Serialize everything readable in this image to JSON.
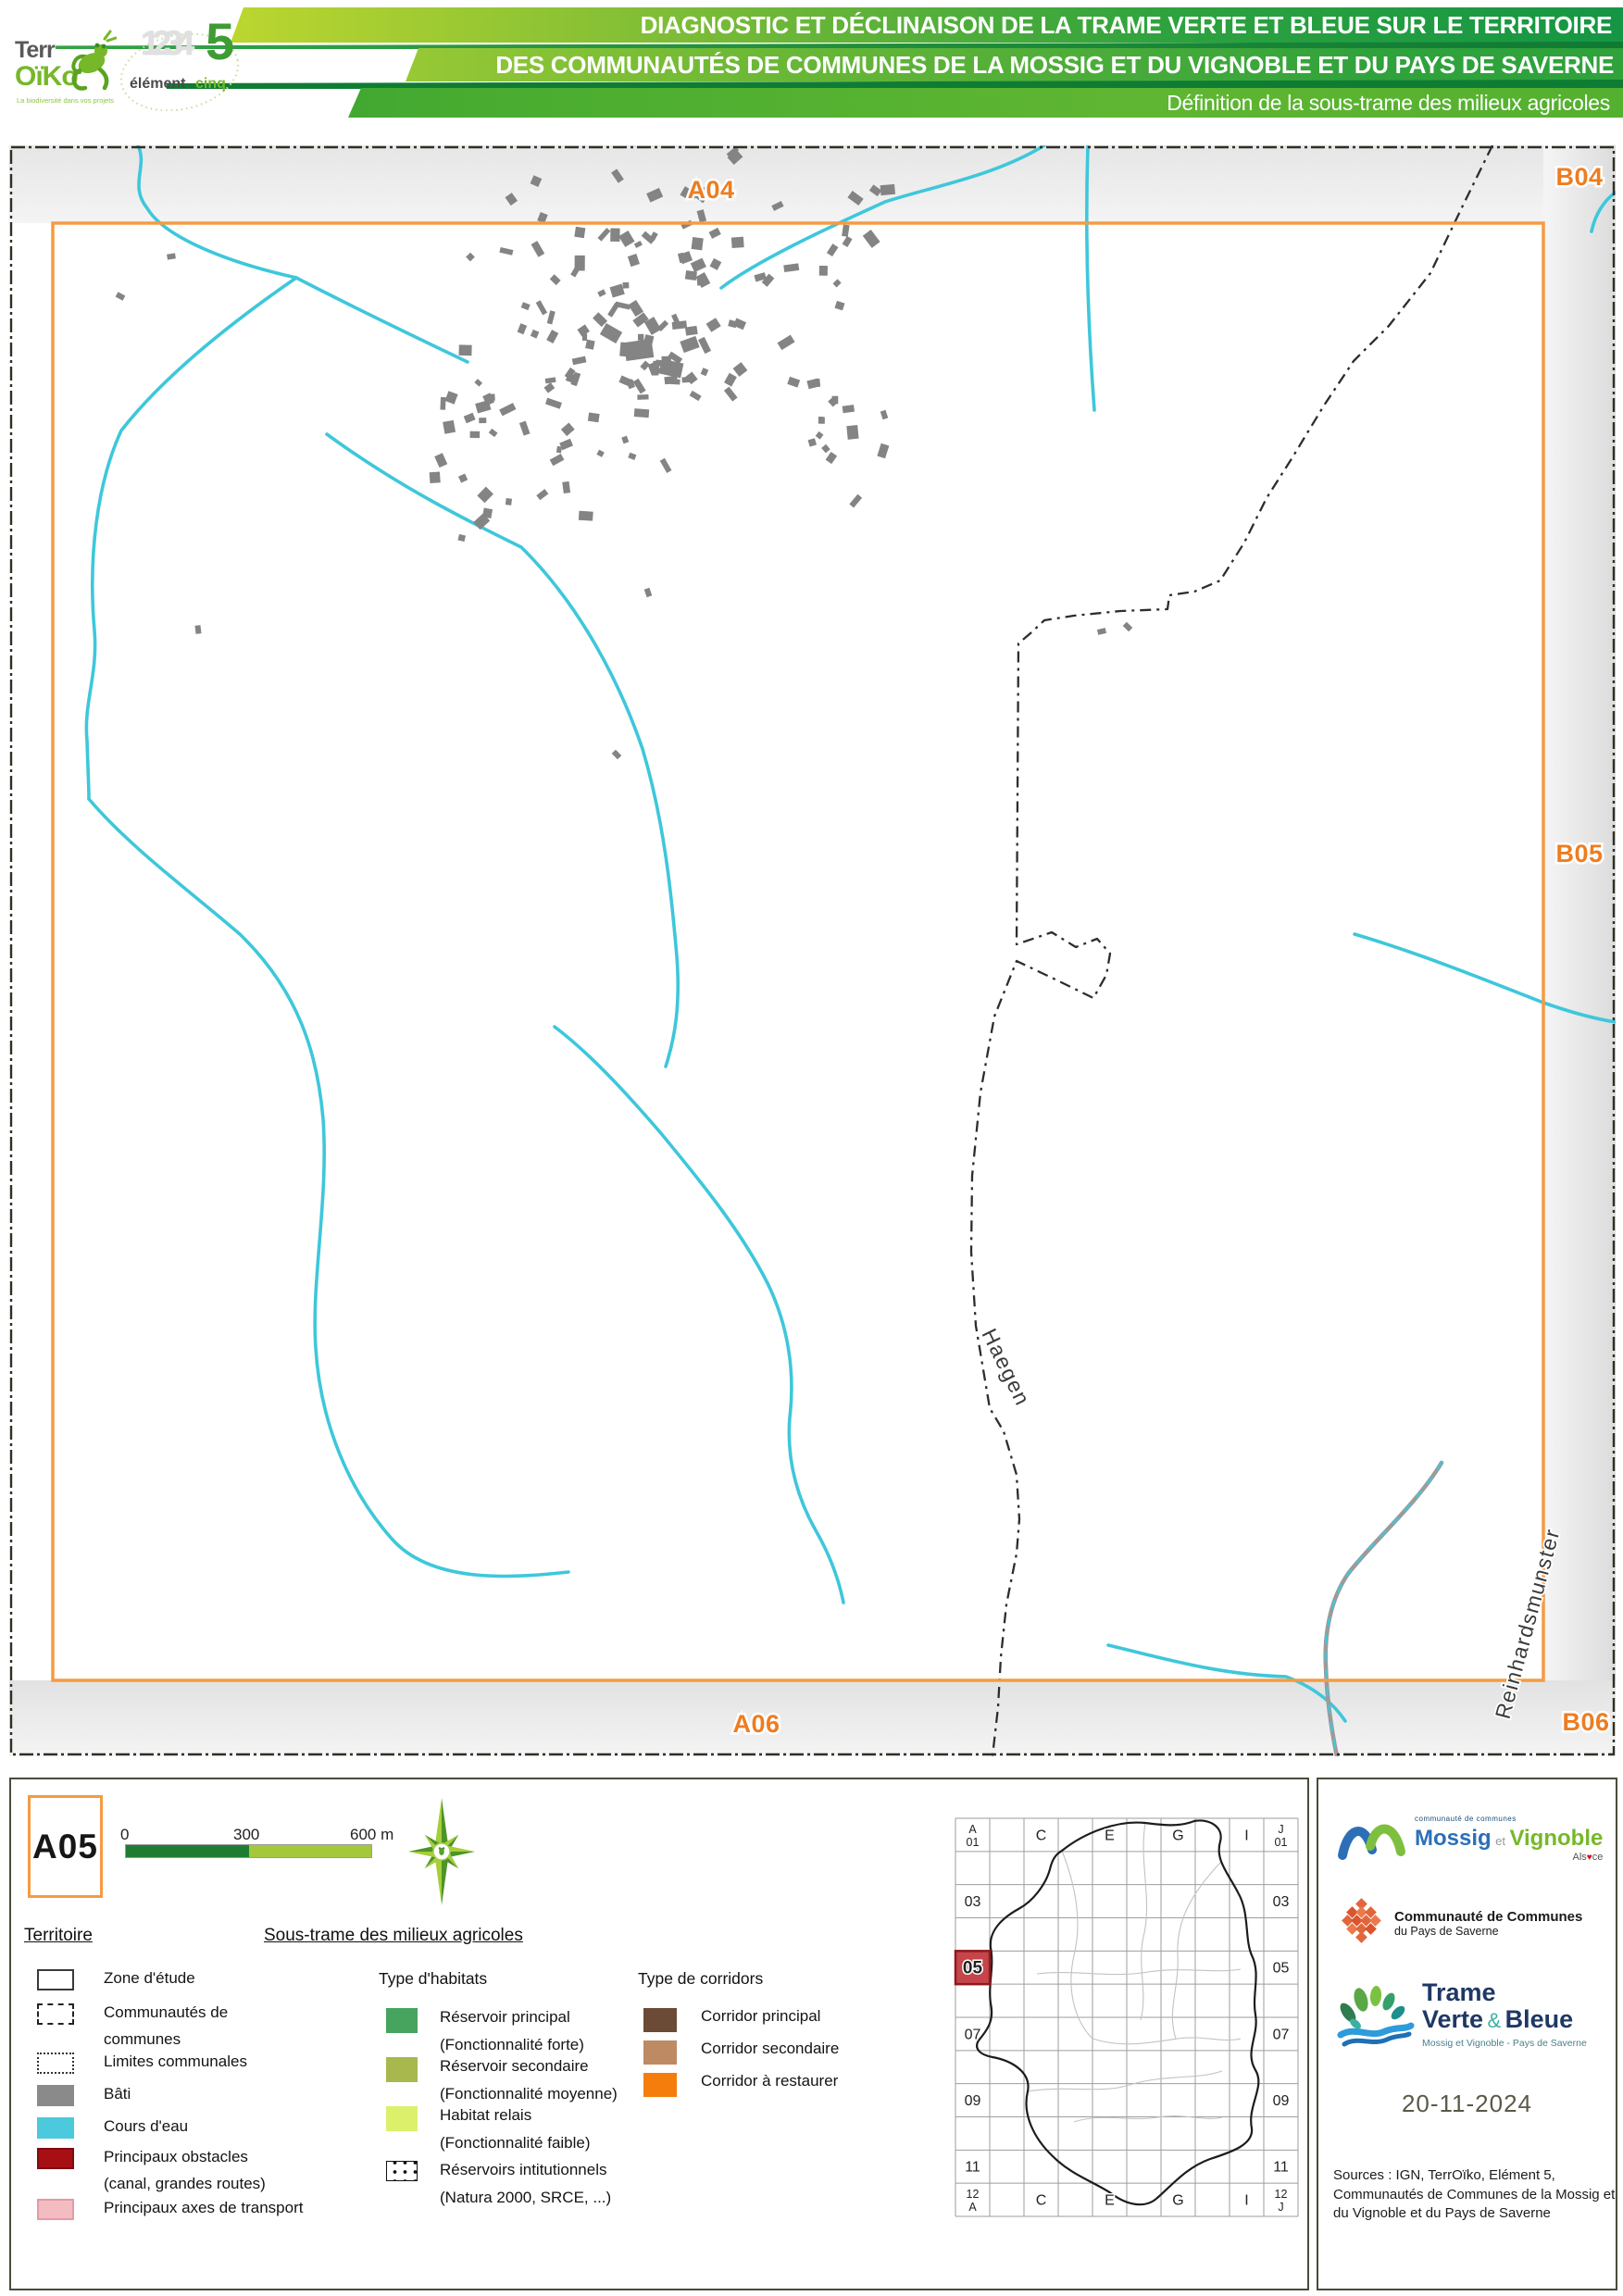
{
  "header": {
    "line1": "DIAGNOSTIC ET DÉCLINAISON DE LA TRAME VERTE ET BLEUE SUR LE TERRITOIRE",
    "line2": "DES COMMUNAUTÉS DE COMMUNES DE LA MOSSIG ET DU VIGNOBLE ET DU PAYS DE SAVERNE",
    "line3": "Définition de la sous-trame des milieux agricoles",
    "terroiko": {
      "part1": "Terr",
      "part2": "OïKo",
      "tagline": "La biodiversité dans vos projets"
    },
    "element5": {
      "digits": "1234",
      "five": "5",
      "word1": "élément",
      "word2": "cinq"
    }
  },
  "map": {
    "frame_labels": {
      "top": "A04",
      "top_right": "B04",
      "right": "B05",
      "bottom": "A06",
      "bottom_right": "B06"
    },
    "communes": {
      "haegen": "Haegen",
      "reinhardsmunster": "Reinhardsmunster"
    }
  },
  "panel": {
    "tile_id": "A05",
    "scalebar": {
      "tick0": "0",
      "tick300": "300",
      "tick600": "600 m"
    },
    "territoire": {
      "title": "Territoire",
      "items": [
        {
          "swatch": "zone",
          "lines": [
            "Zone d'étude"
          ]
        },
        {
          "swatch": "cc",
          "lines": [
            "Communautés de",
            "communes"
          ]
        },
        {
          "swatch": "limites",
          "lines": [
            "Limites communales"
          ]
        },
        {
          "swatch": "bati",
          "lines": [
            "Bâti"
          ]
        },
        {
          "swatch": "eau",
          "lines": [
            "Cours d'eau"
          ]
        },
        {
          "swatch": "obstacles",
          "lines": [
            "Principaux obstacles",
            "(canal, grandes routes)"
          ]
        },
        {
          "swatch": "axes",
          "lines": [
            "Principaux axes de transport"
          ]
        }
      ]
    },
    "soustrame": {
      "title": "Sous-trame des milieux agricoles",
      "habitats": {
        "title": "Type d'habitats",
        "items": [
          {
            "color": "#46A45E",
            "lines": [
              "Réservoir principal",
              "(Fonctionnalité forte)"
            ]
          },
          {
            "color": "#A9B84C",
            "lines": [
              "Réservoir secondaire",
              "(Fonctionnalité moyenne)"
            ]
          },
          {
            "color": "#DDF06B",
            "lines": [
              "Habitat relais",
              "(Fonctionnalité faible)"
            ]
          },
          {
            "color": "dots",
            "lines": [
              "Réservoirs intitutionnels",
              "(Natura 2000, SRCE, ...)"
            ]
          }
        ]
      },
      "corridors": {
        "title": "Type de corridors",
        "items": [
          {
            "color": "#6B4A36",
            "lines": [
              "Corridor principal"
            ]
          },
          {
            "color": "#BE8A63",
            "lines": [
              "Corridor secondaire"
            ]
          },
          {
            "color": "#F47D0B",
            "lines": [
              "Corridor à restaurer"
            ]
          }
        ]
      }
    },
    "indexmap": {
      "highlight": {
        "col": 0,
        "row": 4,
        "label": "05"
      },
      "labels": [
        {
          "side": "left",
          "row": 0,
          "lines": [
            "A",
            "01"
          ]
        },
        {
          "side": "left",
          "row": 2,
          "lines": [
            "03"
          ]
        },
        {
          "side": "left",
          "row": 6,
          "lines": [
            "07"
          ]
        },
        {
          "side": "left",
          "row": 8,
          "lines": [
            "09"
          ]
        },
        {
          "side": "left",
          "row": 10,
          "lines": [
            "11"
          ]
        },
        {
          "side": "left",
          "row": 11,
          "lines": [
            "12",
            "A"
          ]
        },
        {
          "side": "right",
          "row": 0,
          "lines": [
            "J",
            "01"
          ]
        },
        {
          "side": "right",
          "row": 2,
          "lines": [
            "03"
          ]
        },
        {
          "side": "right",
          "row": 4,
          "lines": [
            "05"
          ]
        },
        {
          "side": "right",
          "row": 6,
          "lines": [
            "07"
          ]
        },
        {
          "side": "right",
          "row": 8,
          "lines": [
            "09"
          ]
        },
        {
          "side": "right",
          "row": 10,
          "lines": [
            "11"
          ]
        },
        {
          "side": "right",
          "row": 11,
          "lines": [
            "12",
            "J"
          ]
        },
        {
          "side": "top",
          "col": 2,
          "lines": [
            "C"
          ]
        },
        {
          "side": "top",
          "col": 4,
          "lines": [
            "E"
          ]
        },
        {
          "side": "top",
          "col": 6,
          "lines": [
            "G"
          ]
        },
        {
          "side": "top",
          "col": 8,
          "lines": [
            "I"
          ]
        },
        {
          "side": "bottom",
          "col": 2,
          "lines": [
            "C"
          ]
        },
        {
          "side": "bottom",
          "col": 4,
          "lines": [
            "E"
          ]
        },
        {
          "side": "bottom",
          "col": 6,
          "lines": [
            "G"
          ]
        },
        {
          "side": "bottom",
          "col": 8,
          "lines": [
            "I"
          ]
        }
      ]
    }
  },
  "sidebar": {
    "mossig": {
      "small": "communauté de communes",
      "name1": "Mossig",
      "et": "et",
      "name2": "Vignoble",
      "region_pre": "Als",
      "heart": "♥",
      "region_post": "ce"
    },
    "saverne": {
      "line1": "Communauté de Communes",
      "line2": "du Pays de Saverne"
    },
    "tvb": {
      "line1": "Trame",
      "line2a": "Verte",
      "amp": "&",
      "line2b": "Bleue",
      "subtitle": "Mossig et Vignoble - Pays de Saverne"
    },
    "date": "20-11-2024",
    "sources": [
      "Sources : IGN, TerrOïko, Elément 5,",
      "Communautés de Communes de la Mossig et",
      "du Vignoble et du Pays de Saverne"
    ]
  },
  "colors": {
    "frame_orange": "#F59B43",
    "label_orange": "#ED7D21",
    "water": "#3EC7DB",
    "building": "#848484",
    "obstacle_red": "#A60F14",
    "banner_green_dark": "#159644",
    "banner_green_light": "#BCD62F",
    "highlight_red": "#C5454B"
  }
}
